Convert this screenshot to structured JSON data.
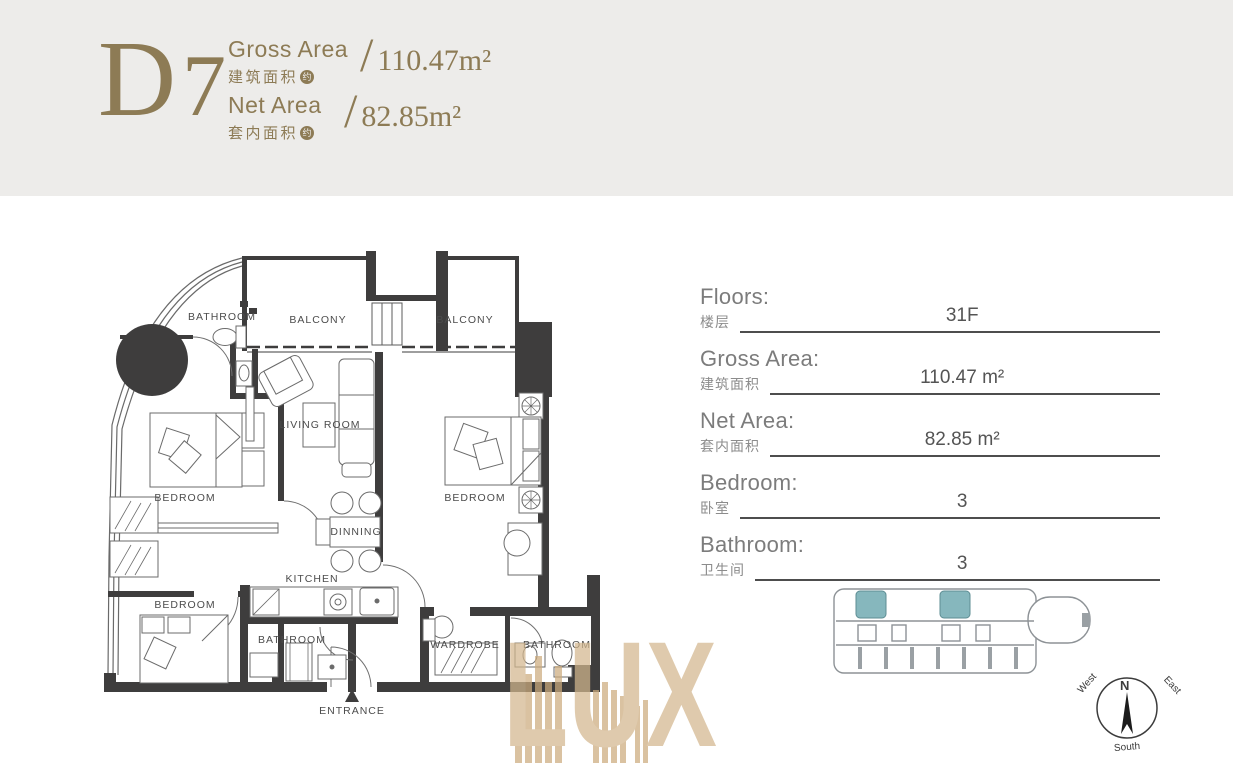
{
  "header": {
    "unit_letter": "D",
    "unit_number": "7",
    "slash": "/",
    "gross": {
      "label_en": "Gross Area",
      "label_zh": "建筑面积",
      "badge": "约",
      "value": "110.47m²"
    },
    "net": {
      "label_en": "Net Area",
      "label_zh": "套内面积",
      "badge": "约",
      "value": "82.85m²"
    }
  },
  "plan": {
    "rooms": [
      "BATHROOM",
      "BALCONY",
      "BALCONY",
      "LIVING ROOM",
      "BEDROOM",
      "BEDROOM",
      "DINNING",
      "BEDROOM",
      "KITCHEN",
      "BATHROOM",
      "WARDROBE",
      "BATHROOM",
      "ENTRANCE"
    ]
  },
  "info": {
    "rows": [
      {
        "en": "Floors:",
        "zh": "楼层",
        "value": "31F"
      },
      {
        "en": "Gross Area:",
        "zh": "建筑面积",
        "value": "110.47 m²"
      },
      {
        "en": "Net Area:",
        "zh": "套内面积",
        "value": "82.85 m²"
      },
      {
        "en": "Bedroom:",
        "zh": "卧室",
        "value": "3"
      },
      {
        "en": "Bathroom:",
        "zh": "卫生间",
        "value": "3"
      }
    ]
  },
  "compass": {
    "north": "N",
    "west": "West",
    "east": "East",
    "south": "South"
  },
  "watermark": {
    "text": "LUX"
  },
  "colors": {
    "header_bg": "#edecea",
    "accent_gold": "#8d7b55",
    "wall": "#3e3d3d",
    "keyplan_highlight": "#86b7bd",
    "watermark_tan": "#d3b78e"
  }
}
